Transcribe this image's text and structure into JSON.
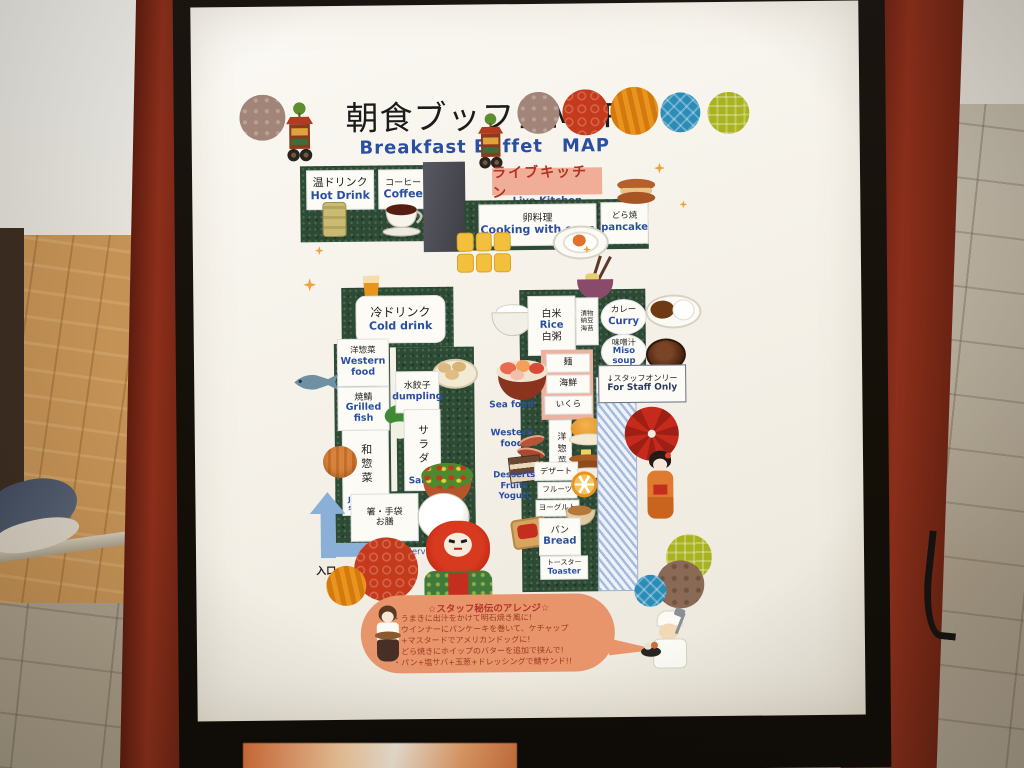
{
  "sign": {
    "title": {
      "jp": "朝食ブッフェMAP",
      "en": "Breakfast Buffet　MAP"
    },
    "stations": {
      "hot_drink": {
        "jp": "温ドリンク",
        "en": "Hot Drink"
      },
      "coffee": {
        "jp": "コーヒー",
        "en": "Coffee"
      },
      "live_kitchen": {
        "jp": "ライブキッチン",
        "en": "Live Kitchen"
      },
      "egg_dishes": {
        "jp": "卵料理",
        "en": "Cooking with eggs"
      },
      "pancake": {
        "jp": "どら焼",
        "en": "pancake"
      },
      "cold_drink": {
        "jp": "冷ドリンク",
        "en": "Cold drink"
      },
      "western_food_left": {
        "jp": "洋惣菜",
        "en_line1": "Western",
        "en_line2": "food"
      },
      "grilled_fish": {
        "jp": "焼鯖",
        "en_line1": "Grilled",
        "en_line2": "fish"
      },
      "dumpling": {
        "jp": "水餃子",
        "en": "dumpling"
      },
      "salad": {
        "jp": "サラダ",
        "en": "Salad"
      },
      "japanese_side_dish": {
        "jp": "和惣菜",
        "en_line1": "Japanese",
        "en_line2": "side dish"
      },
      "cutlery": {
        "jp_line1": "箸・手袋",
        "jp_line2": "お膳",
        "en": "Cutlery/Serving Tray"
      },
      "entrance": {
        "jp": "入口"
      },
      "rice": {
        "jp": "白米",
        "en": "Rice",
        "jp2": "白粥"
      },
      "pickles": [
        "漬物",
        "納豆",
        "海苔"
      ],
      "curry": {
        "jp": "カレー",
        "en": "Curry"
      },
      "miso_soup": {
        "jp": "味噌汁",
        "en": "Miso soup"
      },
      "noodles": {
        "jp": "麺"
      },
      "seafood": {
        "jp": "海鮮",
        "en": "Sea  food"
      },
      "ikura": {
        "jp": "いくら"
      },
      "western_food_right": {
        "jp": "洋惣菜",
        "en_line1": "Western",
        "en_line2": "food"
      },
      "dessert": {
        "jp": "デザート"
      },
      "fruits": {
        "jp": "フルーツ"
      },
      "yogurt": {
        "jp": "ヨーグルト"
      },
      "desserts_en": [
        "Desserts",
        "Fruits",
        "Yogurt"
      ],
      "bread": {
        "jp": "パン",
        "en": "Bread"
      },
      "toaster": {
        "jp": "トースター",
        "en": "Toaster"
      },
      "staff_only": {
        "jp": "↓スタッフオンリー",
        "en": "For Staff Only"
      }
    },
    "notes": {
      "title": "☆スタッフ秘伝のアレンジ☆",
      "lines": [
        "・うまきに出汁をかけて明石焼き風に!",
        "・ウインナーにパンケーキを巻いて、ケチャップ",
        "　+マスタードでアメリカンドッグに!",
        "・どら焼きにホイップのバターを追加で挟んで!",
        "・パン+塩サバ+玉葱+ドレッシングで鯖サンド!!"
      ]
    },
    "colors": {
      "counter_green": "#2c4a34",
      "banner_salmon": "#f0ae98",
      "label_en_blue": "#2b4fa0",
      "accent_red": "#b5342a",
      "notes_orange": "#e8956b",
      "arrow_blue": "#8bb0d8",
      "frame_black": "#17120e",
      "post_maroon": "#7d2718"
    }
  }
}
